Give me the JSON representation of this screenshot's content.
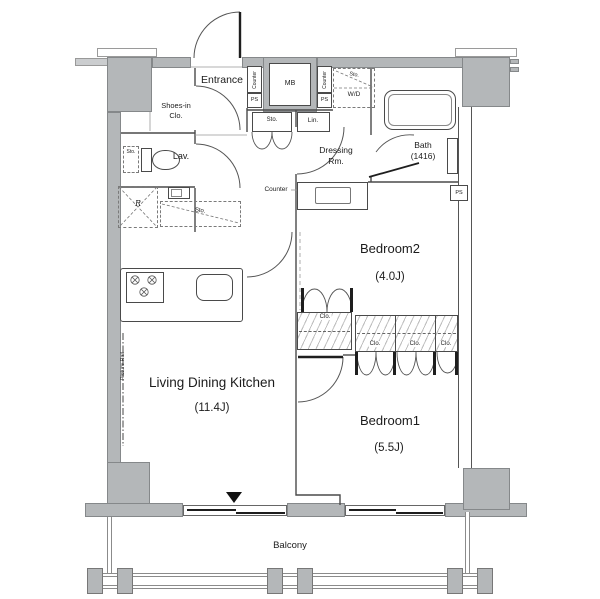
{
  "colors": {
    "wall_fill": "#b4b7b9",
    "wall_light": "#cbcdcf",
    "line": "#4a4a4a",
    "text": "#1c1c1c"
  },
  "rooms": {
    "entrance": {
      "label": "Entrance"
    },
    "shoes_in_closet": {
      "label": "Shoes-in\nClo."
    },
    "lavatory": {
      "label": "Lav."
    },
    "dressing_room": {
      "label": "Dressing\nRm."
    },
    "bathroom": {
      "label": "Bath\n(1416)"
    },
    "bedroom2": {
      "label": "Bedroom2",
      "size": "(4.0J)"
    },
    "bedroom1": {
      "label": "Bedroom1",
      "size": "(5.5J)"
    },
    "ldk": {
      "label": "Living Dining Kitchen",
      "size": "(11.4J)"
    },
    "balcony": {
      "label": "Balcony"
    }
  },
  "labels": {
    "meter_box": "MB",
    "pipe_space": "PS",
    "washer_dryer": "W/D",
    "storage": "Sto.",
    "linen": "Lin.",
    "closet": "Clo.",
    "counter": "Counter",
    "refrigerator": "R",
    "picture_rail": "Picture Rail"
  }
}
